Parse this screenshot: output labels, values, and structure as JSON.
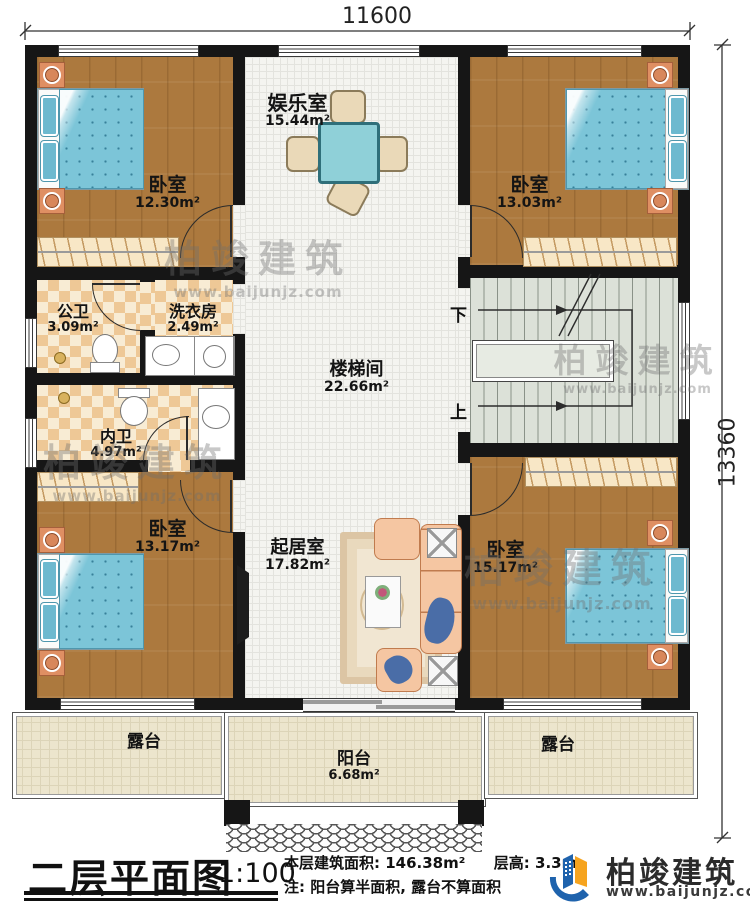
{
  "dimensions": {
    "width_top": "11600",
    "height_right": "13360"
  },
  "rooms": {
    "entertainment": {
      "name": "娱乐室",
      "area": "15.44m²"
    },
    "bedroom_tl": {
      "name": "卧室",
      "area": "12.30m²"
    },
    "bedroom_tr": {
      "name": "卧室",
      "area": "13.03m²"
    },
    "bath_public": {
      "name": "公卫",
      "area": "3.09m²"
    },
    "laundry": {
      "name": "洗衣房",
      "area": "2.49m²"
    },
    "bath_inner": {
      "name": "内卫",
      "area": "4.97m²"
    },
    "stairwell": {
      "name": "楼梯间",
      "area": "22.66m²"
    },
    "living": {
      "name": "起居室",
      "area": "17.82m²"
    },
    "bedroom_bl": {
      "name": "卧室",
      "area": "13.17m²"
    },
    "bedroom_br": {
      "name": "卧室",
      "area": "15.17m²"
    },
    "terrace_left": {
      "name": "露台"
    },
    "balcony": {
      "name": "阳台",
      "area": "6.68m²"
    },
    "terrace_right": {
      "name": "露台"
    }
  },
  "stairs": {
    "down_label": "下",
    "up_label": "上"
  },
  "footer": {
    "title": "二层平面图",
    "scale": "1:100",
    "area_info": "本层建筑面积: 146.38m²",
    "height_info": "层高: 3.3m",
    "note": "注: 阳台算半面积, 露台不算面积"
  },
  "brand": {
    "name": "柏竣建筑",
    "website": "www.baijunjz.com"
  },
  "colors": {
    "wall": "#161616",
    "wood_floor": "#ac793e",
    "tile_floor": "#f4f4f0",
    "checker_dark": "#eec896",
    "checker_light": "#f8ecd4",
    "stair_floor": "#dce1d8",
    "terrace_floor": "#ece5cd",
    "bed": "#7cc5d8",
    "logo_blue": "#1f63ad",
    "logo_orange": "#f6a41f"
  }
}
